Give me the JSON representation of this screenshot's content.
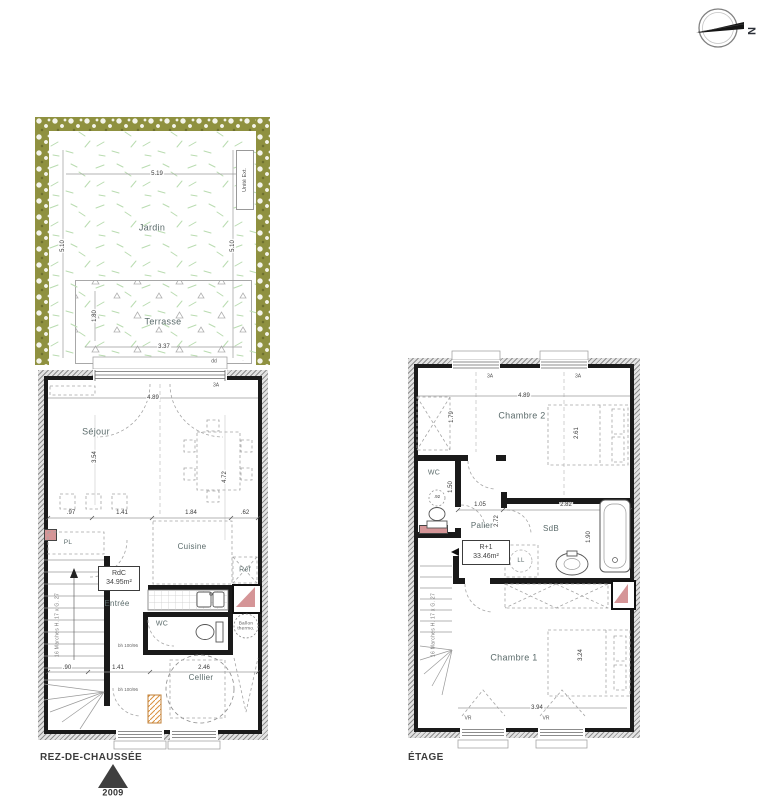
{
  "colors": {
    "hedge": "#8f9140",
    "grass": "#b9dcb0",
    "wall": "#1a1a1a",
    "pink_duct": "#d59597",
    "orange_duct": "#d9913f"
  },
  "compass": {
    "north": "N"
  },
  "gf": {
    "title": "REZ-DE-CHAUSSÉE",
    "marker_year": "2009",
    "rooms": {
      "jardin": "Jardin",
      "terrasse": "Terrasse",
      "sejour": "Séjour",
      "cuisine": "Cuisine",
      "entree": "Entrée",
      "wc": "WC",
      "cellier": "Cellier",
      "pl": "PL",
      "ref": "Réf"
    },
    "labels": {
      "unite_ext": "Unité Ext.",
      "ballon_line1": "Ballon",
      "ballon_line2": "thermo.",
      "area_name": "RdC",
      "area_value": "34.95m²",
      "stairs": "16 Marches H. 17 x G. 27",
      "window_dd": "dd",
      "window_3a": "3A",
      "bh1": "bh 100/96",
      "bh2": "bh 100/96"
    },
    "dims": {
      "jardin_width": "5.19",
      "jardin_depth_left": "5.10",
      "jardin_depth_right": "5.10",
      "terrasse_width": "3.37",
      "terrasse_depth": "1.80",
      "sejour_width": "4.89",
      "sejour_depth": "3.54",
      "sejour_depth2": "4.72",
      "kitchen_1": ".97",
      "kitchen_2": "1.41",
      "kitchen_3": "1.84",
      "kitchen_4": ".62",
      "cellier_1": ".90",
      "cellier_2": "1.41",
      "cellier_3": "2.46"
    }
  },
  "et": {
    "title": "ÉTAGE",
    "rooms": {
      "chambre2": "Chambre 2",
      "chambre1": "Chambre 1",
      "wc": "WC",
      "palier": "Palier",
      "sdb": "SdB"
    },
    "labels": {
      "area_name": "R+1",
      "area_value": "33.46m²",
      "ll": "LL",
      "stairs": "16 Marches H. 17 x G. 27",
      "window_3a_left": "3A",
      "window_3a_right": "3A",
      "vr_left": "VR",
      "vr_right": "VR"
    },
    "dims": {
      "chambre2_width": "4.89",
      "chambre2_left": "1.79",
      "bed2_depth": "2.61",
      "palier_width": "1.05",
      "palier_depth": "2.72",
      "sdb_width": "2.82",
      "sdb_depth": "1.90",
      "wc_width": ".92",
      "wc_depth": "1.50",
      "chambre1_width": "3.94",
      "bed1_depth": "3.24"
    }
  }
}
